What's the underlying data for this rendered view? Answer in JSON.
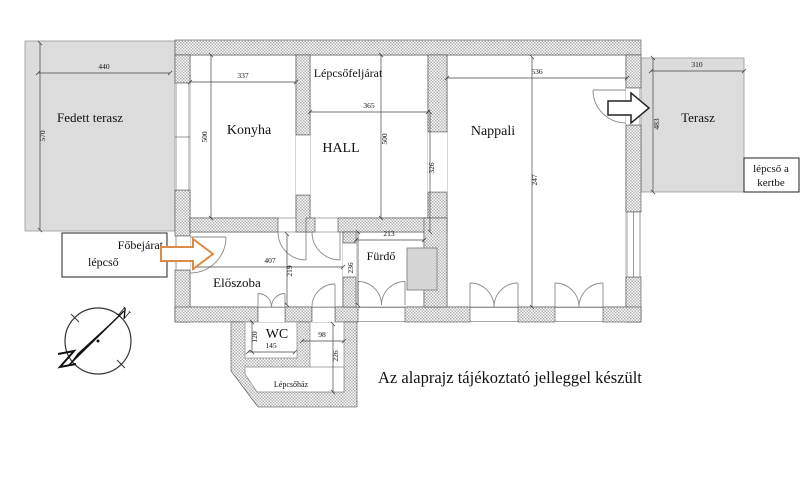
{
  "rooms": {
    "fedett_terasz": "Fedett terasz",
    "konyha": "Konyha",
    "lepcsofeljarat": "Lépcsőfeljárat",
    "hall": "HALL",
    "nappali": "Nappali",
    "terasz": "Terasz",
    "eloszoba": "Előszoba",
    "furdo": "Fürdő",
    "wc": "WC",
    "lepcsohaz": "Lépcsőház"
  },
  "entrance_box": {
    "title": "Főbejárat",
    "subtitle": "lépcső"
  },
  "garden_box": {
    "line1": "lépcső a",
    "line2": "kertbe"
  },
  "note": "Az alaprajz tájékoztató jelleggel készült",
  "compass": {
    "north_letter": "N"
  },
  "dimensions": {
    "fedett_terasz_w": "440",
    "fedett_terasz_h": "570",
    "konyha_w": "337",
    "konyha_h": "500",
    "hall_w": "365",
    "hall_h": "500",
    "hall_h_right": "326",
    "nappali_w": "536",
    "nappali_mid": "247",
    "terasz_w": "310",
    "terasz_h": "483",
    "eloszoba_w": "407",
    "eloszoba_h": "219",
    "furdo_w": "213",
    "furdo_h": "236",
    "wc_w": "145",
    "wc_h": "120",
    "folyoso_w": "98",
    "folyoso_h": "226"
  },
  "colors": {
    "accent_orange": "#dd8a45",
    "terrace_gray": "#dcdcdc"
  }
}
